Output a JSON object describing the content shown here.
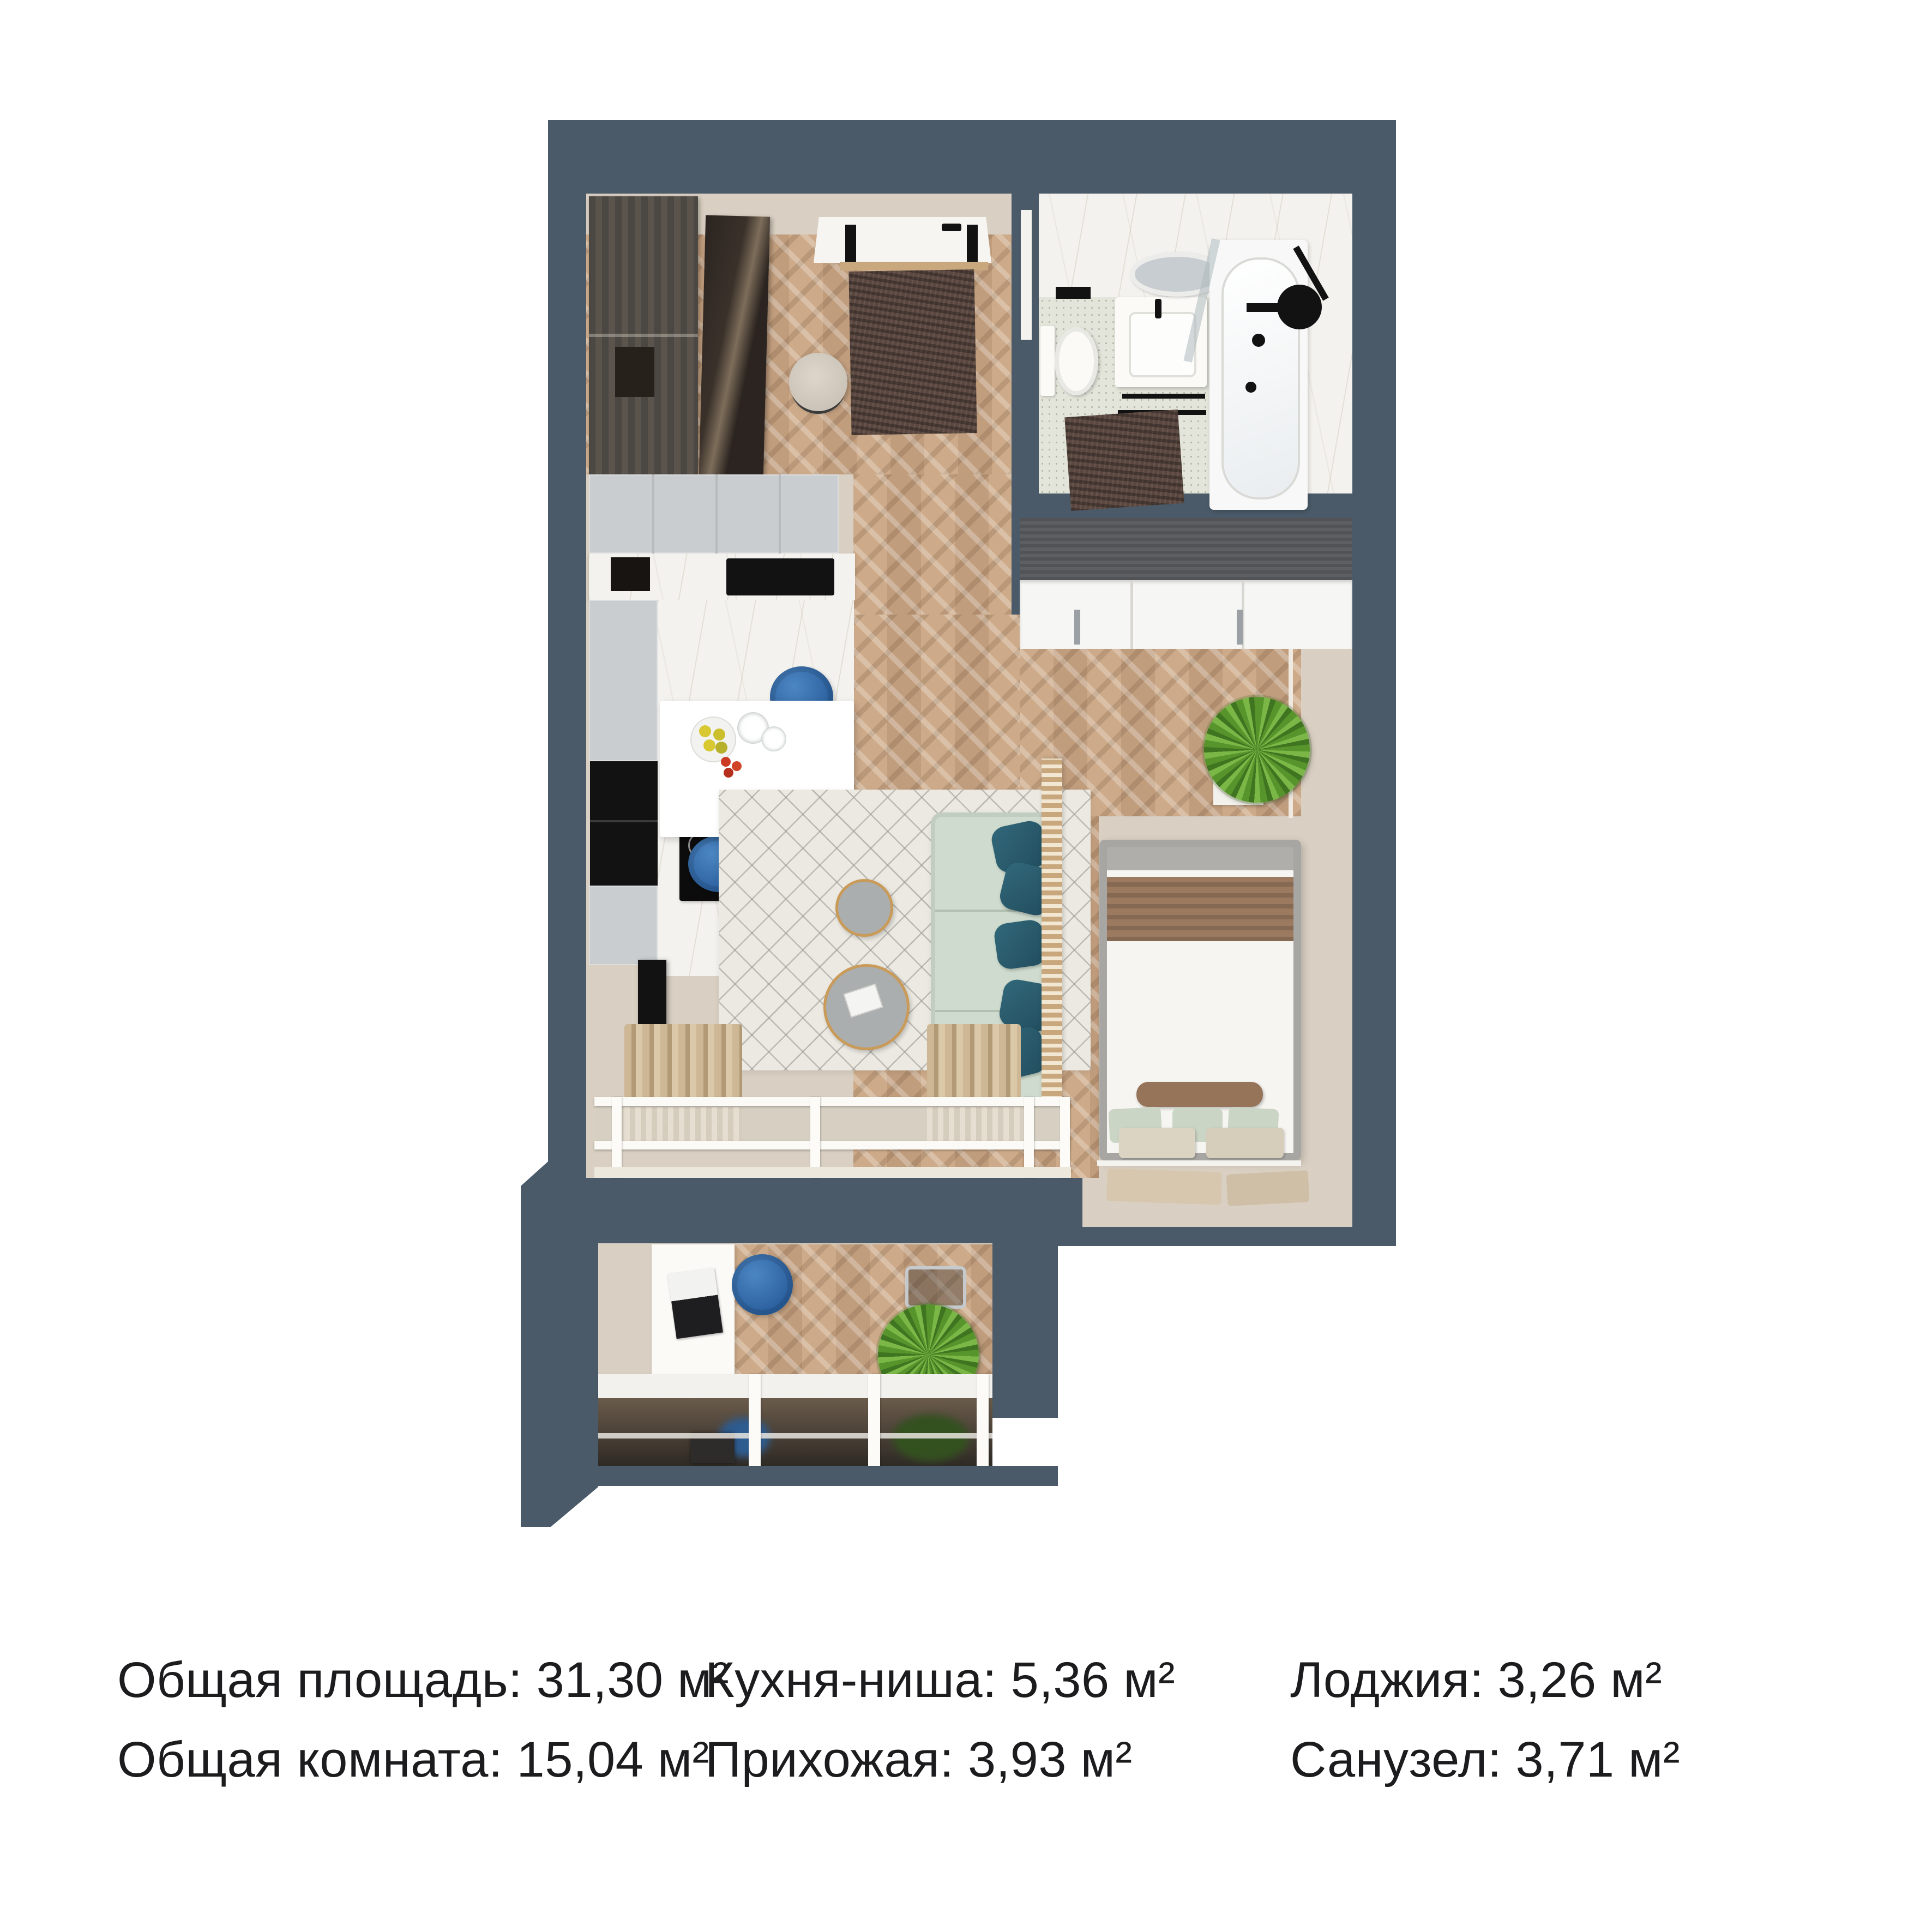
{
  "stats": {
    "columns": [
      {
        "items": [
          {
            "label": "Общая площадь:",
            "value": "31,30",
            "unit": "м²"
          },
          {
            "label": "Общая комната:",
            "value": "15,04",
            "unit": "м²"
          }
        ]
      },
      {
        "items": [
          {
            "label": "Кухня-ниша:",
            "value": "5,36",
            "unit": "м²"
          },
          {
            "label": "Прихожая:",
            "value": "3,93",
            "unit": "м²"
          }
        ]
      },
      {
        "items": [
          {
            "label": "Лоджия:",
            "value": "3,26",
            "unit": "м²"
          },
          {
            "label": "Санузел:",
            "value": "3,71",
            "unit": "м²"
          }
        ]
      }
    ]
  },
  "kitchen": {
    "cooktop_display": "1659"
  },
  "colors": {
    "wall": "#4a5a68",
    "wood_floor": "#c8a886",
    "beige_floor": "#d9cfc2",
    "accent_blue": "#2e6cab",
    "sofa_sage": "#cedbce",
    "pillow_teal": "#2f6678",
    "text": "#1c1c1e"
  }
}
